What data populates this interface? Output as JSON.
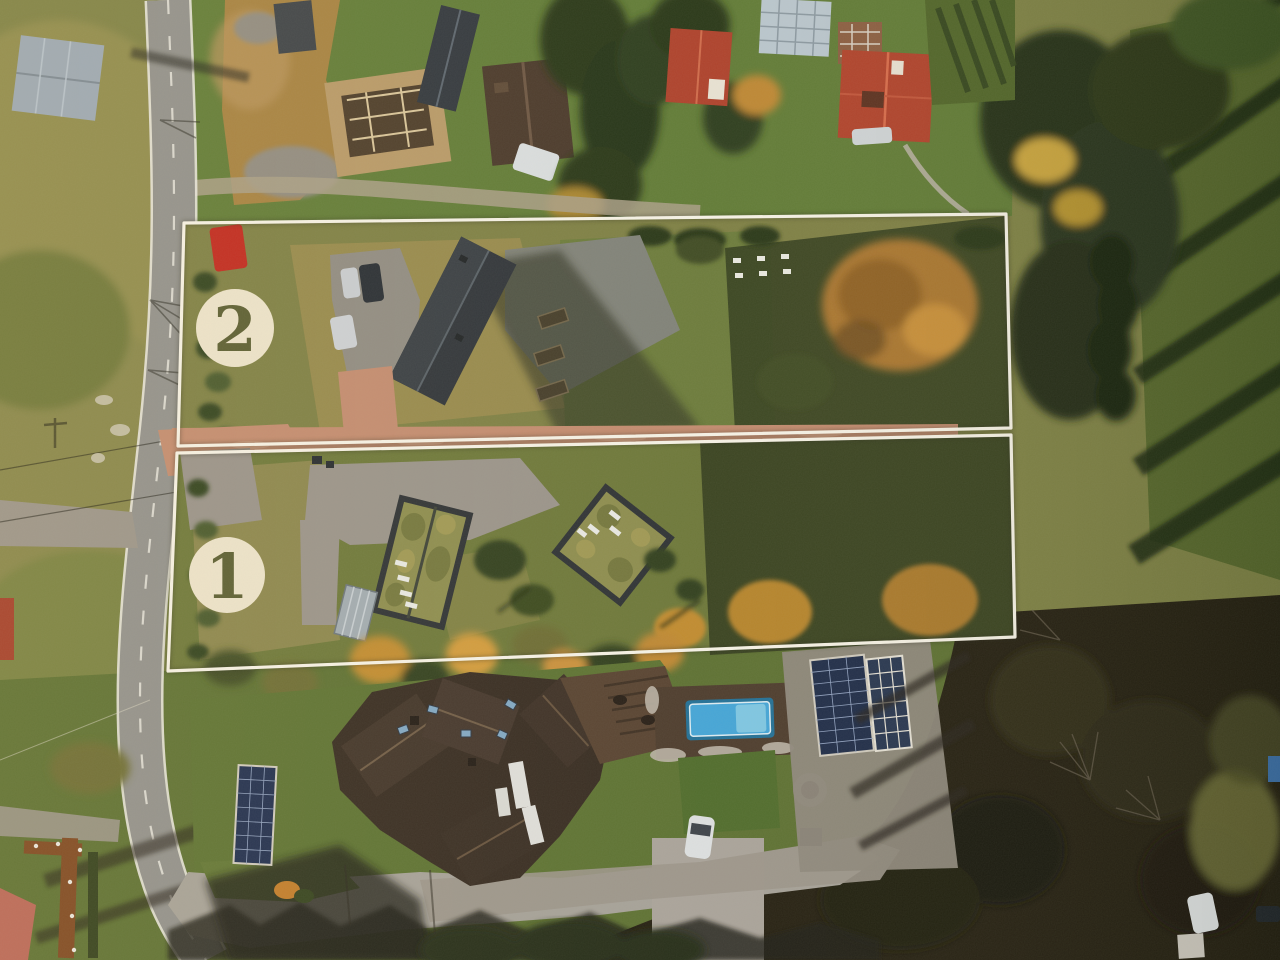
{
  "scene": {
    "type": "aerial-drone-photo",
    "subject": "Aerial view of two residential building plots outlined in white, autumn",
    "plot_markers": [
      {
        "id": "plot-2",
        "label": "2"
      },
      {
        "id": "plot-1",
        "label": "1"
      }
    ],
    "colors": {
      "boundary_line": "#f6f2e7",
      "badge_fill": "#ece3cc",
      "badge_number": "#575b30",
      "road_asphalt": "#8f8f8c",
      "paved_drive": "#c28a6f",
      "pool_water": "#41a4d8",
      "red_roof": "#b0402a",
      "green_roof": "#8b8b4d",
      "dark_roof": "#2c3138",
      "forest_dark": "#221d10",
      "autumn_foliage": "#bd8630"
    }
  }
}
